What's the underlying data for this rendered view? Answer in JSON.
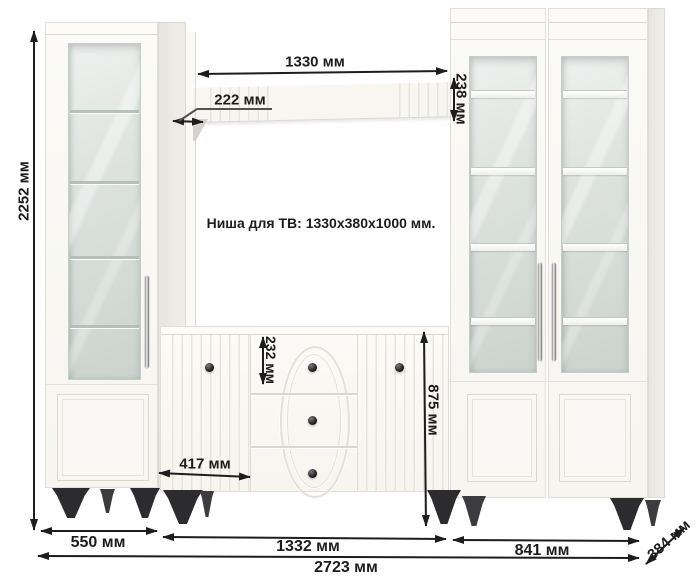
{
  "diagram": {
    "niche_note": "Ниша для ТВ: 1330x380x1000 мм.",
    "dimensions": {
      "total_height": "2252 мм",
      "shelf_width": "1330 мм",
      "shelf_depth": "222 мм",
      "shelf_side_height": "238 мм",
      "top_drawer_height": "232 мм",
      "sideboard_height": "875 мм",
      "door_width": "417 мм",
      "left_cabinet_width": "550 мм",
      "center_section_width": "1332 мм",
      "right_section_width": "841 мм",
      "total_width": "2723 мм",
      "depth": "384 мм"
    },
    "colors": {
      "background": "#ffffff",
      "furniture_white": "#f8f7f2",
      "furniture_side": "#ecebe5",
      "glass": "#d8deda",
      "dimension_ink": "#1d1d1d",
      "legs": "#2c2c2e",
      "chrome_handle": "#c9c9c9"
    }
  }
}
